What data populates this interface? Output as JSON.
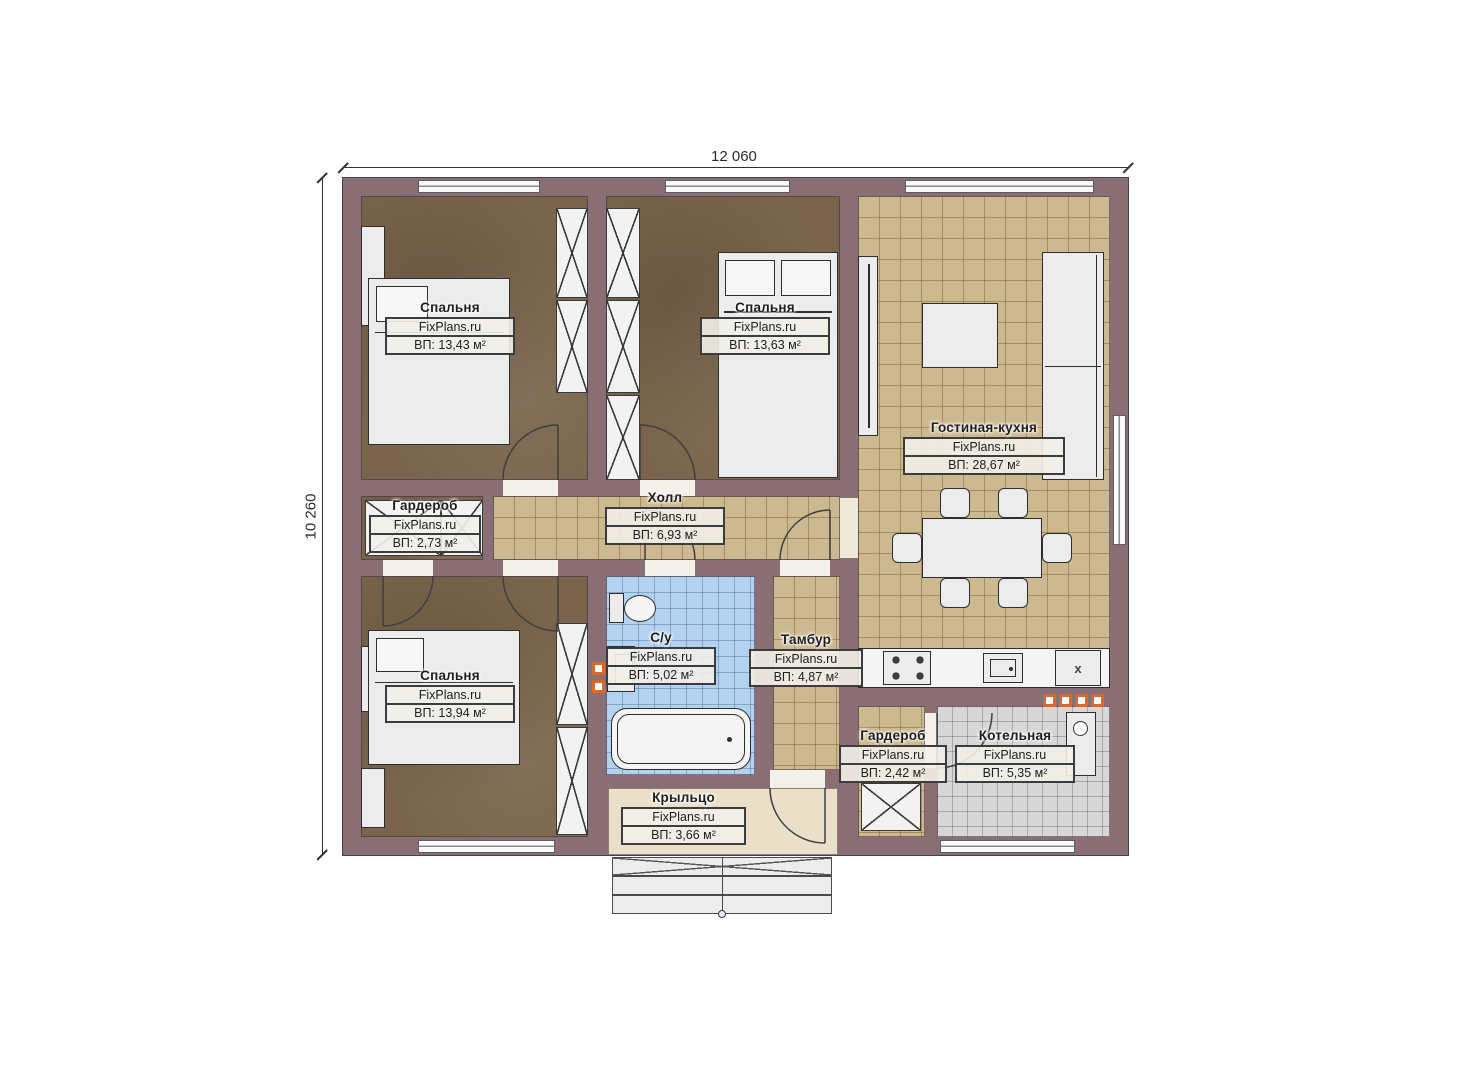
{
  "dimensions": {
    "width": "12 060",
    "height": "10 260"
  },
  "rooms": {
    "bedroom1": {
      "name": "Спальня",
      "brand": "FixPlans.ru",
      "area": "ВП: 13,43 м²"
    },
    "bedroom2": {
      "name": "Спальня",
      "brand": "FixPlans.ru",
      "area": "ВП: 13,63 м²"
    },
    "living_kitchen": {
      "name": "Гостиная-кухня",
      "brand": "FixPlans.ru",
      "area": "ВП: 28,67 м²"
    },
    "wardrobe1": {
      "name": "Гардероб",
      "brand": "FixPlans.ru",
      "area": "ВП: 2,73 м²"
    },
    "hall": {
      "name": "Холл",
      "brand": "FixPlans.ru",
      "area": "ВП: 6,93 м²"
    },
    "bedroom3": {
      "name": "Спальня",
      "brand": "FixPlans.ru",
      "area": "ВП: 13,94 м²"
    },
    "bathroom": {
      "name": "С/у",
      "brand": "FixPlans.ru",
      "area": "ВП: 5,02 м²"
    },
    "tambour": {
      "name": "Тамбур",
      "brand": "FixPlans.ru",
      "area": "ВП: 4,87 м²"
    },
    "wardrobe2": {
      "name": "Гардероб",
      "brand": "FixPlans.ru",
      "area": "ВП: 2,42 м²"
    },
    "boiler": {
      "name": "Котельная",
      "brand": "FixPlans.ru",
      "area": "ВП: 5,35 м²"
    },
    "porch": {
      "name": "Крыльцо",
      "brand": "FixPlans.ru",
      "area": "ВП: 3,66 м²"
    }
  },
  "symbols": {
    "appliance_x": "x"
  },
  "colors": {
    "wall": "#8a6e76",
    "bedroom_floor": "#7a654c",
    "tile_floor": "#cdb98f",
    "bath_floor": "#b3d2ef",
    "boiler_floor": "#d7d7d7",
    "porch_floor": "#eadfc9",
    "accent_orange": "#d66a2a"
  }
}
